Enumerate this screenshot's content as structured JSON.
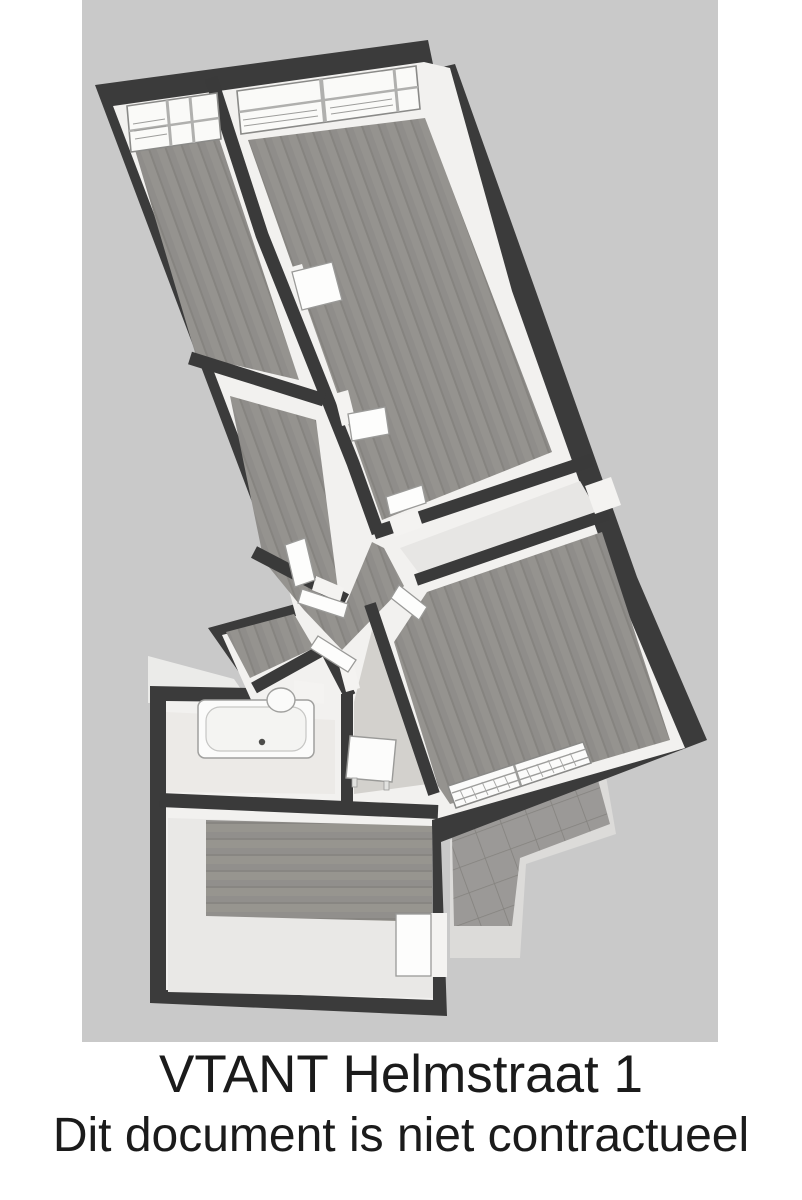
{
  "caption": {
    "line1": "VTANT Helmstraat 1",
    "line2": "Dit document is niet contractueel"
  },
  "floorplan": {
    "type": "apartment-floor-plan-3d-top-view",
    "colors": {
      "page_background": "#ffffff",
      "backdrop": "#c9c9c9",
      "outer_walls": "#3b3b3b",
      "wall_faces": "#f2f1ef",
      "wood_floor": "#8f8d8a",
      "light_floor": "#e9e8e6",
      "terrace_tiles": "#9b9997",
      "terrace_apron": "#dcdbd9",
      "fixtures": "#fbfbfa",
      "caption_text": "#1b1b1b"
    },
    "visible_elements": [
      "top-left-room",
      "top-right-room",
      "middle-left-room",
      "hallway",
      "entry-corridor",
      "living-room",
      "connector-room",
      "bathroom",
      "bathtub",
      "sink",
      "small-room",
      "side-table",
      "kitchen-room",
      "kitchen-door",
      "terrace-tiles",
      "top-windows",
      "radiator-window",
      "open-door-leaves"
    ]
  }
}
